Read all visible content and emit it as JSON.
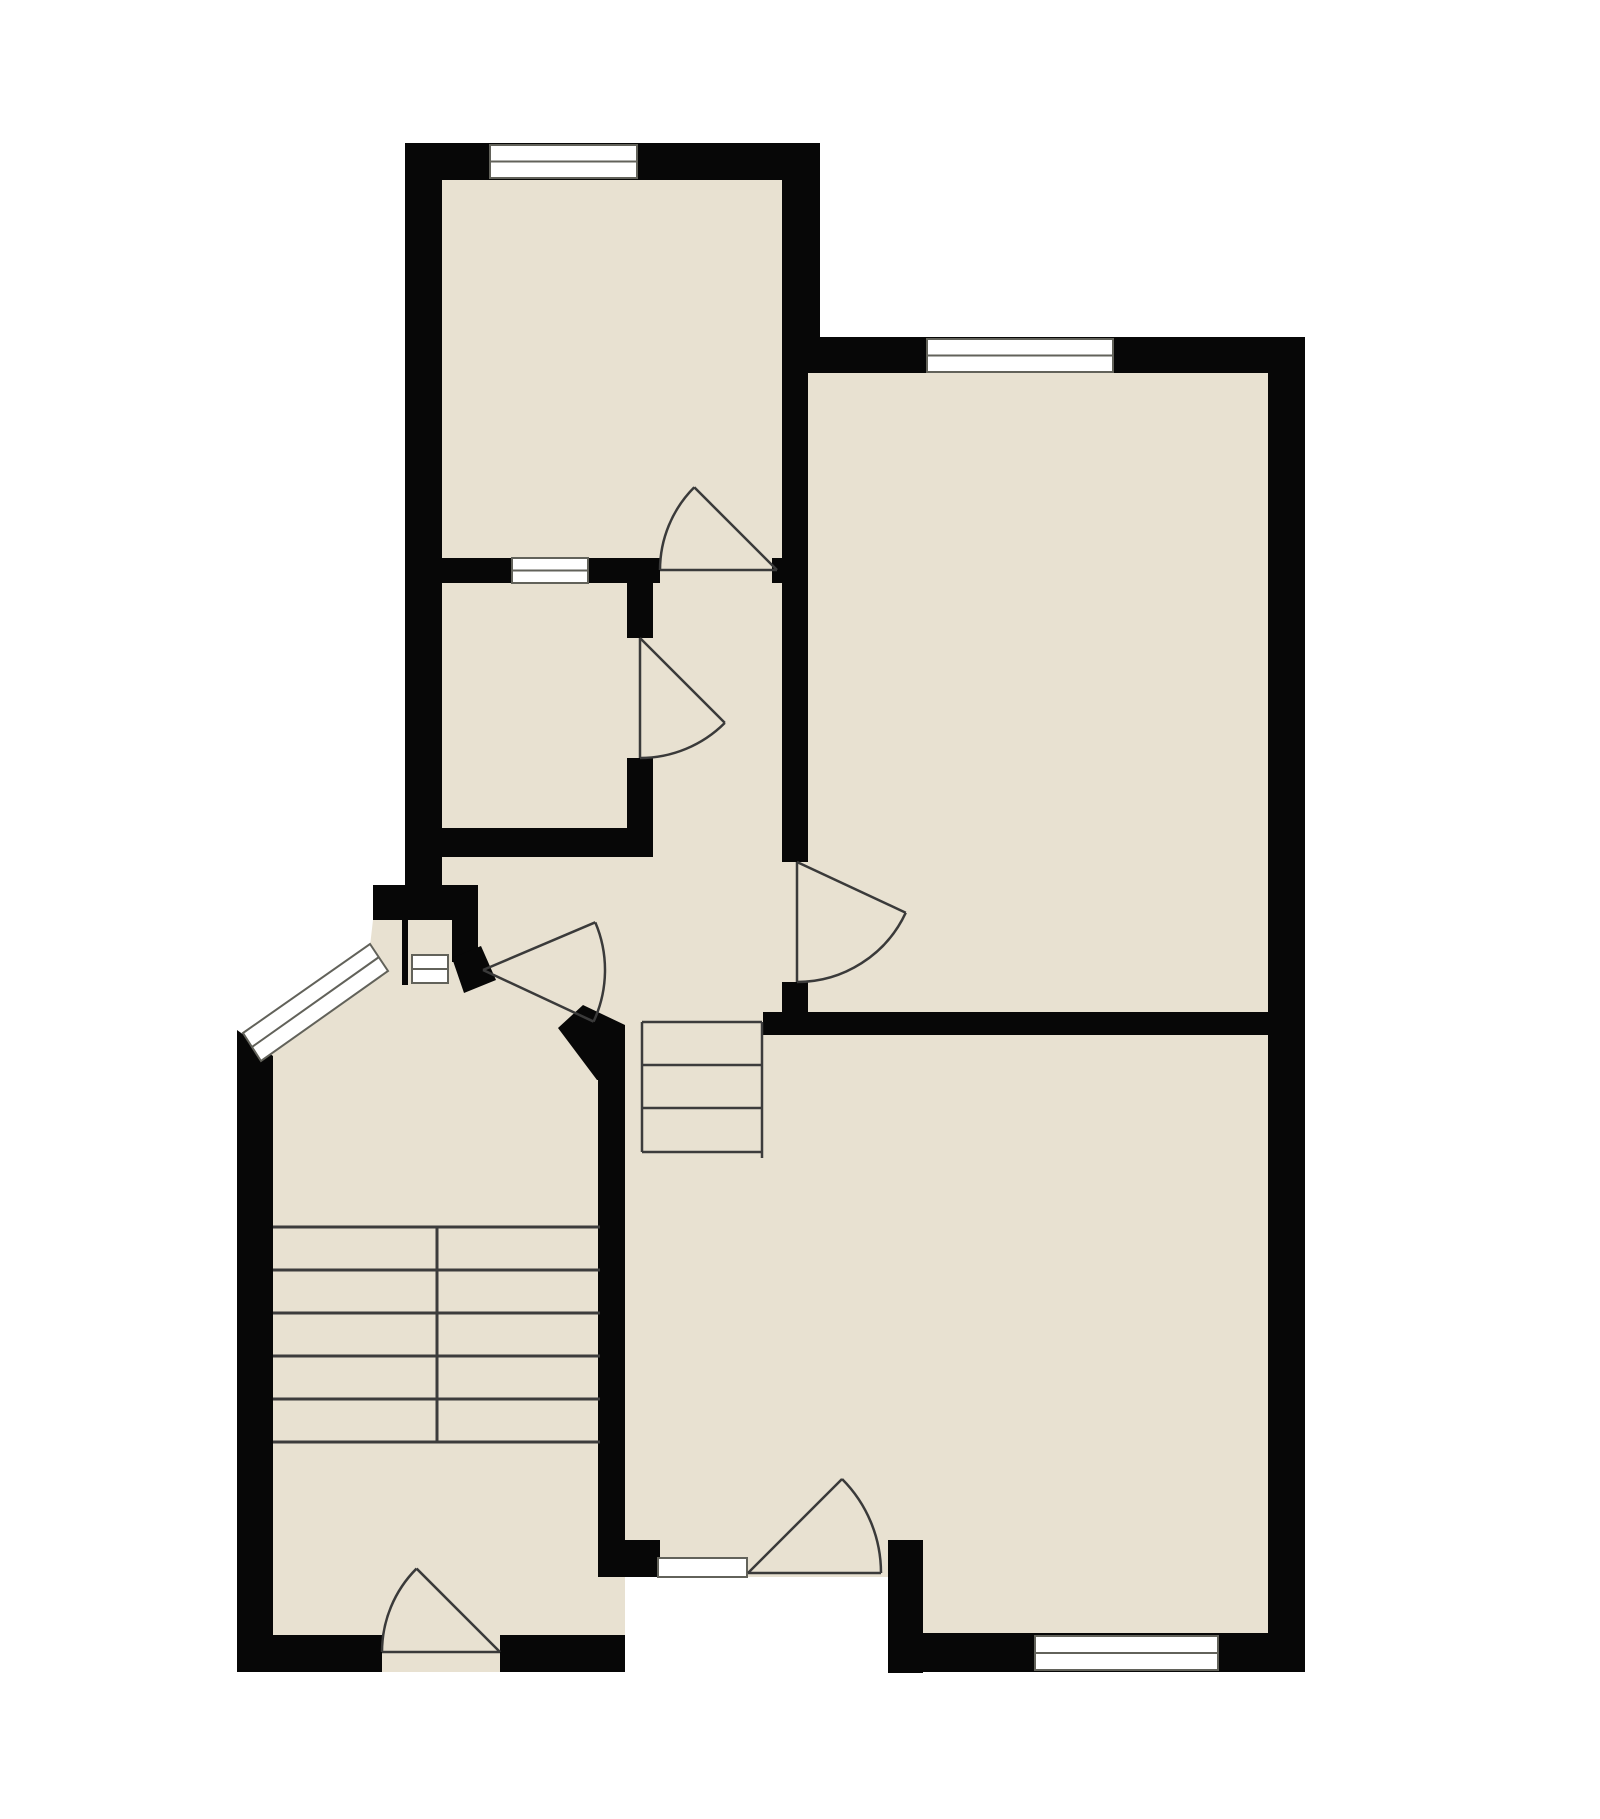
{
  "title": "apartment-floor-plan",
  "canvas": {
    "width": 1600,
    "height": 1819,
    "background": "#ffffff"
  },
  "colors": {
    "floor": "#e8e1d1",
    "wall": "#070707",
    "window_fill": "#ffffff",
    "window_stroke": "#62625a",
    "door_stroke": "#3a3a3a",
    "stair_stroke": "#3c3c3c"
  },
  "footprint": [
    [
      405,
      143
    ],
    [
      820,
      143
    ],
    [
      820,
      338
    ],
    [
      1305,
      338
    ],
    [
      1305,
      1672
    ],
    [
      888,
      1672
    ],
    [
      888,
      1577
    ],
    [
      625,
      1577
    ],
    [
      625,
      1672
    ],
    [
      237,
      1672
    ],
    [
      237,
      1038
    ],
    [
      370,
      946
    ],
    [
      373,
      920
    ],
    [
      373,
      885
    ],
    [
      405,
      885
    ]
  ],
  "rooms": [
    {
      "id": "top-left-room",
      "bounds": [
        442,
        180,
        782,
        558
      ]
    },
    {
      "id": "middle-small-room",
      "bounds": [
        442,
        583,
        627,
        828
      ]
    },
    {
      "id": "right-room",
      "bounds": [
        808,
        373,
        1268,
        1012
      ]
    },
    {
      "id": "hallway",
      "bounds": [
        653,
        583,
        783,
        1012
      ]
    },
    {
      "id": "stair-hall",
      "bounds": [
        273,
        1060,
        598,
        1635
      ]
    },
    {
      "id": "bottom-right-room",
      "bounds": [
        625,
        1035,
        1268,
        1633
      ]
    }
  ],
  "walls_rects": [
    [
      405,
      143,
      415,
      37
    ],
    [
      405,
      143,
      37,
      742
    ],
    [
      782,
      143,
      38,
      195
    ],
    [
      442,
      558,
      218,
      25
    ],
    [
      772,
      558,
      36,
      25
    ],
    [
      627,
      583,
      26,
      55
    ],
    [
      627,
      758,
      26,
      99
    ],
    [
      442,
      828,
      211,
      29
    ],
    [
      782,
      338,
      26,
      524
    ],
    [
      782,
      982,
      26,
      30
    ],
    [
      782,
      337,
      523,
      36
    ],
    [
      1268,
      337,
      37,
      1335
    ],
    [
      763,
      1012,
      505,
      23
    ],
    [
      888,
      1633,
      417,
      39
    ],
    [
      888,
      1540,
      35,
      133
    ],
    [
      625,
      1540,
      35,
      37
    ],
    [
      598,
      1040,
      27,
      537
    ],
    [
      237,
      1635,
      145,
      37
    ],
    [
      500,
      1635,
      125,
      37
    ],
    [
      373,
      885,
      105,
      35
    ],
    [
      402,
      920,
      6,
      65
    ],
    [
      452,
      920,
      26,
      42
    ]
  ],
  "walls_polys": [
    [
      [
        237,
        1030
      ],
      [
        273,
        1056
      ],
      [
        273,
        1672
      ],
      [
        237,
        1672
      ]
    ],
    [
      [
        583,
        1005
      ],
      [
        625,
        1025
      ],
      [
        625,
        1080
      ],
      [
        597,
        1080
      ],
      [
        558,
        1028
      ]
    ],
    [
      [
        452,
        958
      ],
      [
        481,
        946
      ],
      [
        496,
        980
      ],
      [
        464,
        993
      ]
    ]
  ],
  "windows": [
    {
      "id": "window-top-left-room",
      "shape": "rect",
      "x": 490,
      "y": 145,
      "w": 147,
      "h": 33,
      "mid": true
    },
    {
      "id": "window-partition",
      "shape": "rect",
      "x": 512,
      "y": 558,
      "w": 76,
      "h": 25,
      "mid": true
    },
    {
      "id": "window-right-room",
      "shape": "rect",
      "x": 927,
      "y": 339,
      "w": 186,
      "h": 33,
      "mid": true
    },
    {
      "id": "window-bottom-right",
      "shape": "rect",
      "x": 1035,
      "y": 1636,
      "w": 183,
      "h": 34,
      "mid": true
    },
    {
      "id": "window-entry-sill",
      "shape": "rect",
      "x": 658,
      "y": 1558,
      "w": 89,
      "h": 19,
      "mid": false
    },
    {
      "id": "window-bay-niche",
      "shape": "rect",
      "x": 412,
      "y": 955,
      "w": 36,
      "h": 28,
      "mid": true
    },
    {
      "id": "window-angled-bay",
      "shape": "poly",
      "points": [
        [
          243,
          1033
        ],
        [
          370,
          944
        ],
        [
          388,
          971
        ],
        [
          261,
          1061
        ]
      ],
      "midline": [
        [
          252,
          1047
        ],
        [
          379,
          957
        ]
      ]
    }
  ],
  "doors": [
    {
      "id": "door-top-left-room",
      "hinge": [
        777,
        570
      ],
      "r": 117,
      "closed": 180,
      "open": 225
    },
    {
      "id": "door-small-room",
      "hinge": [
        640,
        638
      ],
      "r": 120,
      "closed": 90,
      "open": 45
    },
    {
      "id": "door-right-room",
      "hinge": [
        797,
        862
      ],
      "r": 120,
      "closed": 90,
      "open": 25
    },
    {
      "id": "door-entrance",
      "hinge": [
        483,
        970
      ],
      "r": 122,
      "closed": 25,
      "open": -23
    },
    {
      "id": "door-bottom-room",
      "hinge": [
        748,
        1573
      ],
      "r": 133,
      "closed": 0,
      "open": -45
    },
    {
      "id": "door-stair-hall",
      "hinge": [
        500,
        1652
      ],
      "r": 118,
      "closed": 180,
      "open": 225
    }
  ],
  "stairs": {
    "small": {
      "x1": 642,
      "x2": 762,
      "lines": [
        1022,
        1065,
        1108,
        1152
      ],
      "rails": [
        [
          642,
          1022,
          642,
          1152
        ],
        [
          762,
          1022,
          762,
          1158
        ]
      ]
    },
    "main": {
      "x1": 273,
      "x2": 600,
      "lines": [
        1227,
        1270,
        1313,
        1356,
        1399,
        1442
      ],
      "divider": [
        437,
        1227,
        437,
        1442
      ]
    }
  }
}
